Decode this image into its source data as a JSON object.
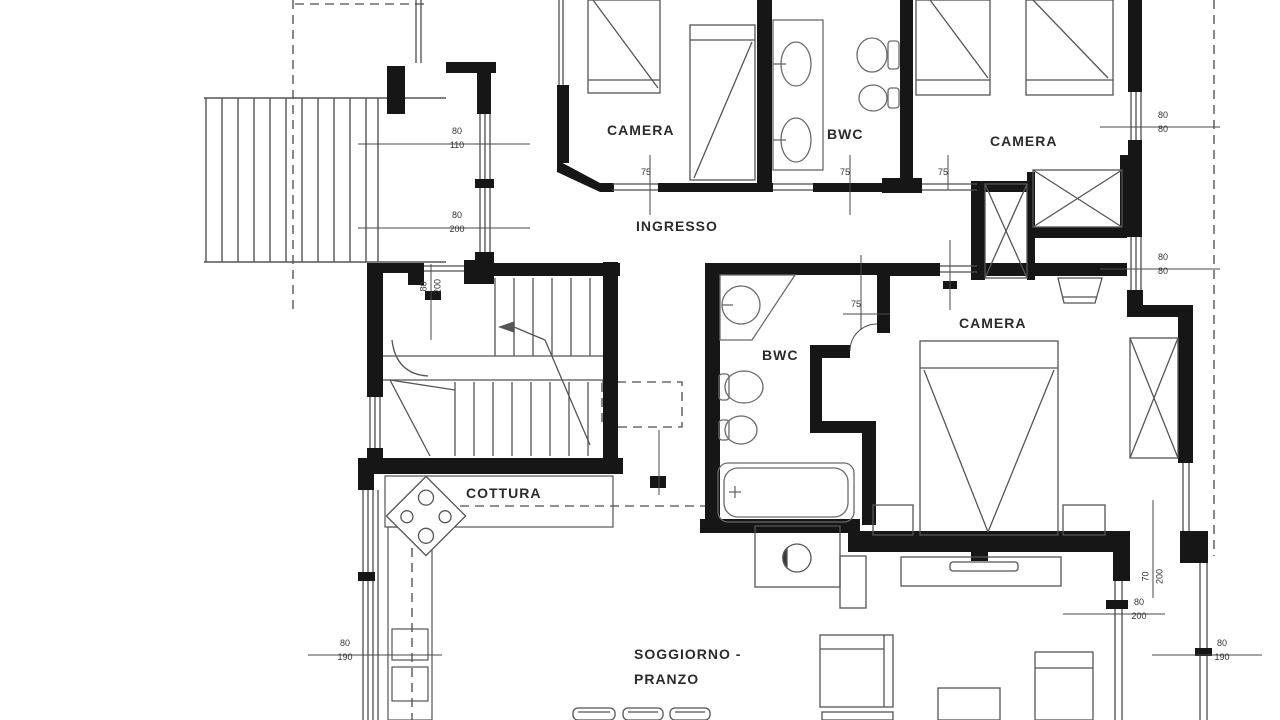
{
  "document": {
    "type": "architectural floor plan",
    "language": "italian",
    "colors": {
      "wall": "#161616",
      "line": "#4d4d4d",
      "fixture": "#6a6a6a",
      "background": "#ffffff"
    }
  },
  "rooms": {
    "camera_top_left": "CAMERA",
    "bwc_top": "BWC",
    "camera_top_right": "CAMERA",
    "ingresso": "INGRESSO",
    "bwc_middle": "BWC",
    "camera_right": "CAMERA",
    "cottura": "COTTURA",
    "soggiorno_line1": "SOGGIORNO -",
    "soggiorno_line2": "PRANZO"
  },
  "dimensions": {
    "left_window_upper_w": "80",
    "left_window_upper_h": "110",
    "left_door_w": "80",
    "left_door_h": "200",
    "stair_door_w": "80",
    "stair_door_h": "200",
    "door_camera_top_left": "75",
    "door_bwc_top": "75",
    "door_camera_top_right": "75",
    "door_bwc_middle": "75",
    "right_window_upper_w": "80",
    "right_window_upper_h": "80",
    "right_window_mid_w": "80",
    "right_window_mid_h": "80",
    "right_passage_w": "70",
    "right_passage_h": "200",
    "right_door_lower_w": "80",
    "right_door_lower_h": "200",
    "right_window_lower_w": "80",
    "right_window_lower_h": "190",
    "left_window_lower_w": "80",
    "left_window_lower_h": "190"
  }
}
